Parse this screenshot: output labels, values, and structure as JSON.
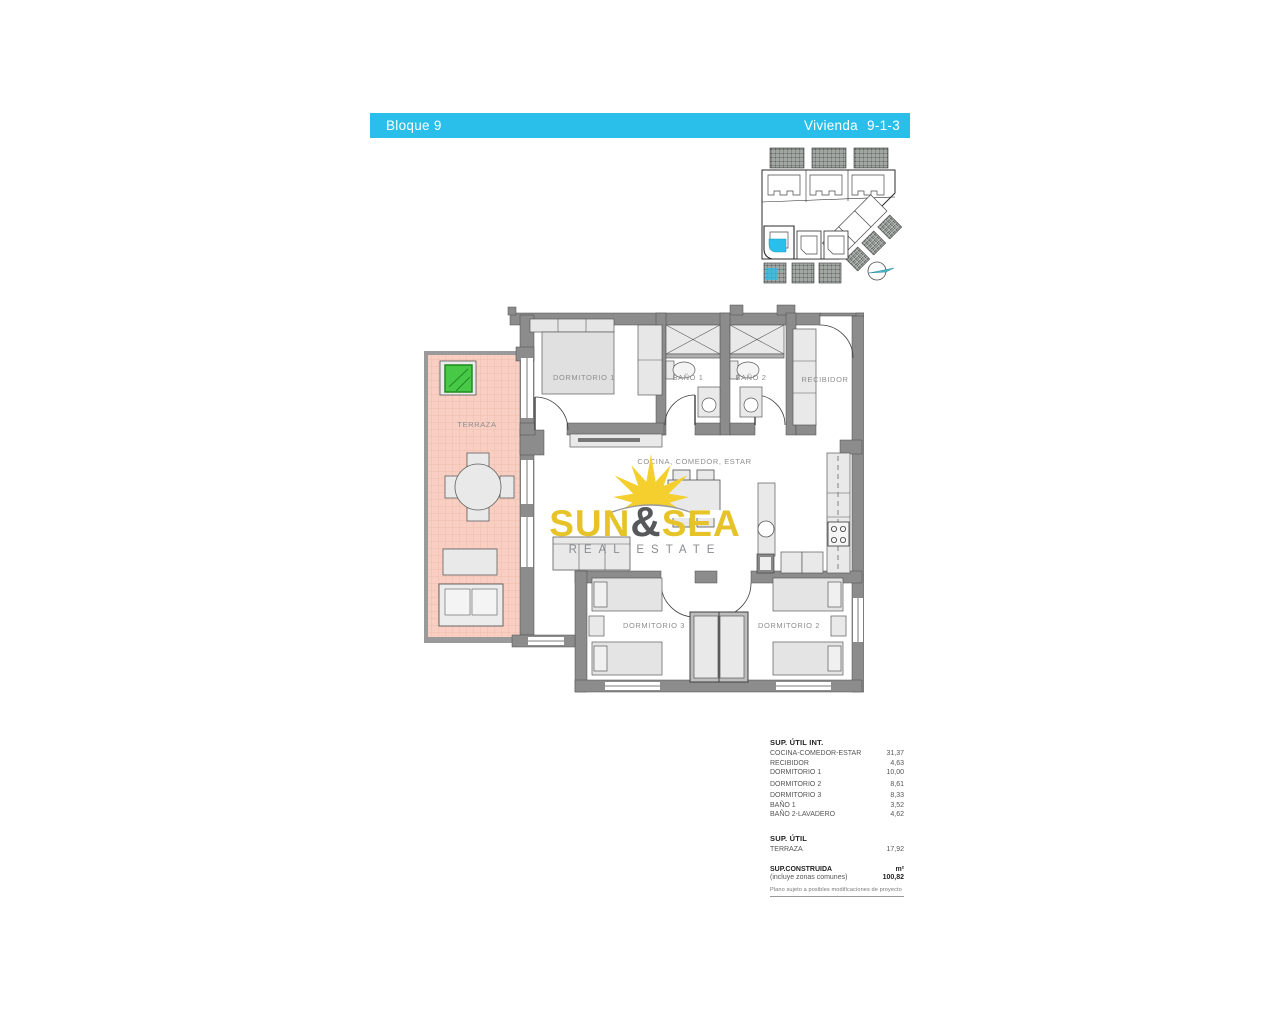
{
  "header": {
    "left": "Bloque 9",
    "right_label": "Vivienda",
    "right_value": "9-1-3"
  },
  "rooms": {
    "terraza": "TERRAZA",
    "dormitorio1": "DORMITORIO 1",
    "bano1": "BAÑO 1",
    "bano2": "BAÑO 2",
    "recibidor": "RECIBIDOR",
    "cocina": "COCINA, COMEDOR, ESTAR",
    "dormitorio3": "DORMITORIO 3",
    "dormitorio2": "DORMITORIO 2"
  },
  "logo": {
    "word1": "SUN",
    "ampersand": "&",
    "word2": "SEA",
    "tagline": "REAL ESTATE"
  },
  "areas": {
    "util_int": {
      "title": "SUP. ÚTIL INT.",
      "rows": [
        {
          "label": "COCINA-COMEDOR-ESTAR",
          "value": "31,37"
        },
        {
          "label": "RECIBIDOR",
          "value": "4,63"
        },
        {
          "label": "DORMITORIO 1",
          "value": "10,00"
        },
        {
          "label": "DORMITORIO 2",
          "value": "8,61"
        },
        {
          "label": "DORMITORIO 3",
          "value": "8,33"
        },
        {
          "label": "BAÑO 1",
          "value": "3,52"
        },
        {
          "label": "BAÑO 2-LAVADERO",
          "value": "4,62"
        }
      ]
    },
    "util": {
      "title": "SUP. ÚTIL",
      "rows": [
        {
          "label": "TERRAZA",
          "value": "17,92"
        }
      ]
    },
    "construida": {
      "title": "SUP.CONSTRUIDA",
      "unit": "m²",
      "subtitle": "(incluye zonas comunes)",
      "value": "100,82"
    },
    "disclaimer": "Plano sujeto a posibles modificaciones de proyecto"
  },
  "colors": {
    "accent": "#29bfea",
    "terrace": "#f8cfc2",
    "terrace_grid": "#efbcad",
    "wall": "#8c8c8c",
    "gold": "#e7c32a",
    "plant_green": "#47c847"
  }
}
